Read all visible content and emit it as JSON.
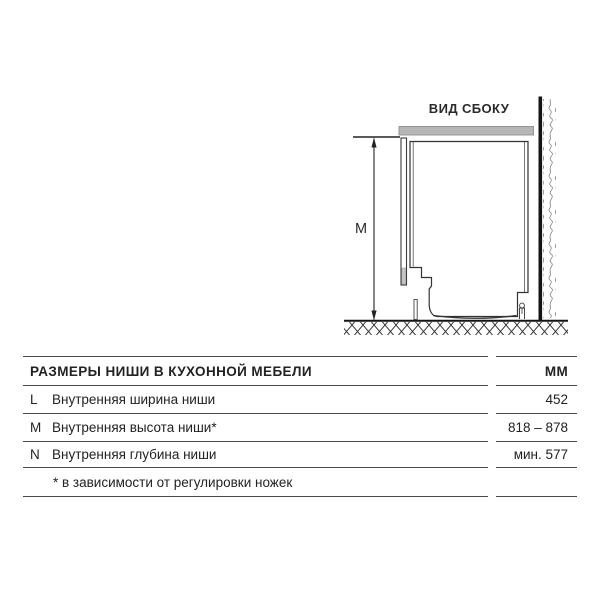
{
  "diagram": {
    "title": "ВИД СБОКУ",
    "dimension_label": "M"
  },
  "table": {
    "header": {
      "title": "РАЗМЕРЫ НИШИ В КУХОННОЙ МЕБЕЛИ",
      "unit": "ММ"
    },
    "rows": [
      {
        "key": "L",
        "label": "Внутренняя ширина ниши",
        "value": "452"
      },
      {
        "key": "M",
        "label": "Внутренняя высота ниши*",
        "value": "818 – 878"
      },
      {
        "key": "N",
        "label": "Внутренняя глубина ниши",
        "value": "мин. 577"
      }
    ],
    "footnote": "* в зависимости от регулировки ножек"
  },
  "colors": {
    "countertop_gray": "#b6b6b6",
    "outline": "#333333",
    "wall_black": "#141414",
    "table_rule": "#4a4a4a",
    "text": "#222222"
  }
}
